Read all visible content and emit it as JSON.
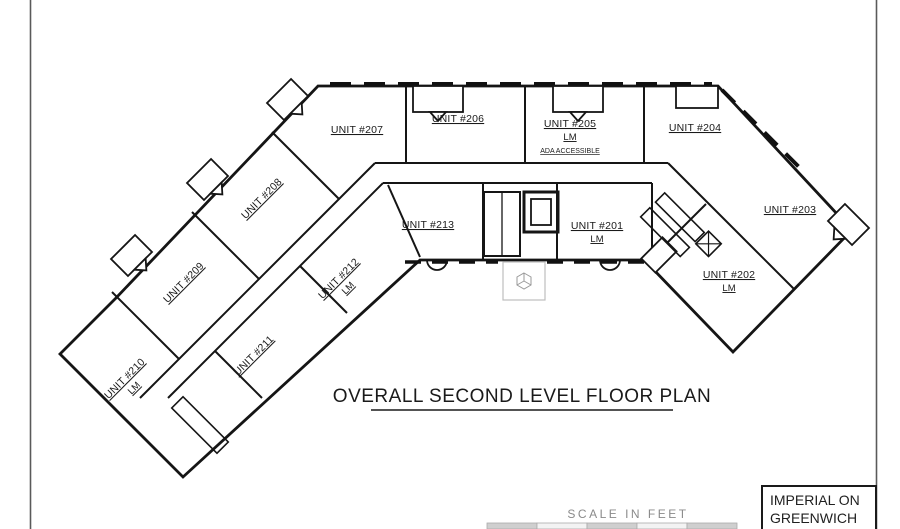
{
  "sheet": {
    "title": "OVERALL SECOND LEVEL FLOOR PLAN",
    "scale_label": "SCALE IN FEET",
    "title_block": {
      "line1": "IMPERIAL ON",
      "line2": "GREENWICH"
    }
  },
  "plan": {
    "units": [
      {
        "id": "207",
        "label": "UNIT #207",
        "sub": []
      },
      {
        "id": "206",
        "label": "UNIT #206",
        "sub": []
      },
      {
        "id": "205",
        "label": "UNIT #205",
        "sub": [
          "LM",
          "ADA ACCESSIBLE"
        ]
      },
      {
        "id": "204",
        "label": "UNIT #204",
        "sub": []
      },
      {
        "id": "203",
        "label": "UNIT #203",
        "sub": []
      },
      {
        "id": "202",
        "label": "UNIT #202",
        "sub": [
          "LM"
        ]
      },
      {
        "id": "201",
        "label": "UNIT #201",
        "sub": [
          "LM"
        ]
      },
      {
        "id": "213",
        "label": "UNIT #213",
        "sub": []
      },
      {
        "id": "212",
        "label": "UNIT #212",
        "sub": [
          "LM"
        ]
      },
      {
        "id": "211",
        "label": "UNIT #211",
        "sub": []
      },
      {
        "id": "210",
        "label": "UNIT #210",
        "sub": [
          "LM"
        ]
      },
      {
        "id": "209",
        "label": "UNIT #209",
        "sub": []
      },
      {
        "id": "208",
        "label": "UNIT #208",
        "sub": []
      }
    ]
  },
  "colors": {
    "line": "#151515",
    "muted": "#8a8a8a",
    "light": "#c8c8c8"
  }
}
